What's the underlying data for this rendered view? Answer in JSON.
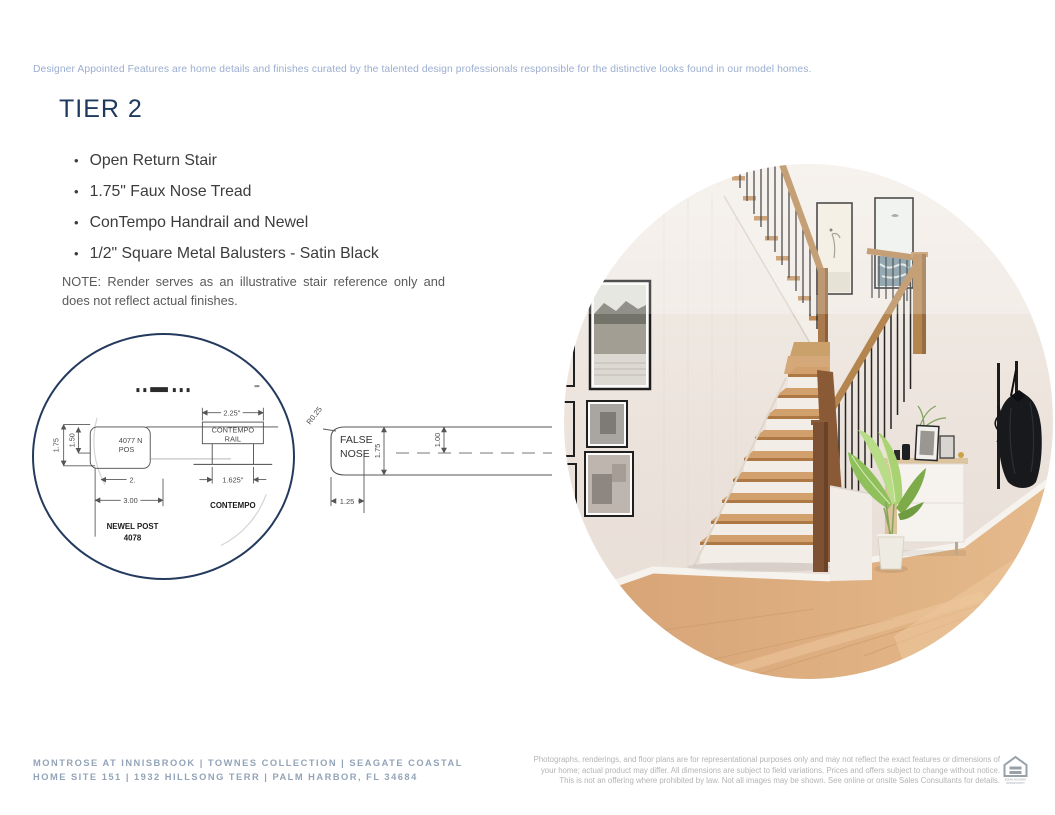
{
  "header": {
    "disclaimer": "Designer Appointed Features are home details and finishes curated by the talented design professionals responsible for the distinctive looks found in our model homes."
  },
  "tier": {
    "title": "TIER 2",
    "bullets": [
      "Open Return Stair",
      "1.75\" Faux Nose Tread",
      "ConTempo Handrail and Newel",
      "1/2\" Square Metal Balusters - Satin Black"
    ],
    "note_line1": "NOTE: Render serves as an illustrative stair reference only and",
    "note_line2": "does not reflect actual finishes."
  },
  "diagram": {
    "newel": {
      "dim_height": "1.75",
      "dim_inner": "1.50",
      "label_part1": "4077 N",
      "label_part2": "POS",
      "dim_clipped": "2.",
      "dim_width": "3.00",
      "caption1": "NEWEL POST",
      "caption2": "4078"
    },
    "contempo": {
      "dim_top": "2.25\"",
      "rail_label1": "CONTEMPO",
      "rail_label2": "RAIL",
      "dim_bottom": "1.625\"",
      "caption": "CONTEMPO"
    },
    "false_nose": {
      "radius_label": "R0.25",
      "label1": "FALSE",
      "label2": "NOSE",
      "dim_height": "1.75",
      "dim_mid": "1.00",
      "dim_depth": "1.25"
    }
  },
  "footer": {
    "left_line1": "MONTROSE AT INNISBROOK  |  TOWNES COLLECTION   | SEAGATE COASTAL",
    "left_line2": "HOME SITE 151  |  1932 HILLSONG TERR  |  PALM HARBOR, FL 34684",
    "right_line1": "Photographs, renderings, and floor plans are for representational purposes only and may not reflect the exact features or dimensions of",
    "right_line2": "your home; actual product may differ. All dimensions are subject to field variations. Prices and offers subject to change without notice.",
    "right_line3": "This is not an offering where prohibited by law. Not all images may be shown. See online or onsite Sales Consultants for details.",
    "eho_line1": "EQUAL HOUSING",
    "eho_line2": "OPPORTUNITY"
  },
  "colors": {
    "accent_navy": "#1d3a5e",
    "disclaimer_blue": "#9badd0",
    "footer_blue_gray": "#93a4b8",
    "legal_gray": "#b4b4b4",
    "body_text": "#3c3c3c",
    "drawing_line": "#555555",
    "handrail_oak": "#b5854f",
    "tread_oak": "#d2a06c",
    "dark_newel": "#7d5132",
    "floor_oak": "#dca878"
  }
}
